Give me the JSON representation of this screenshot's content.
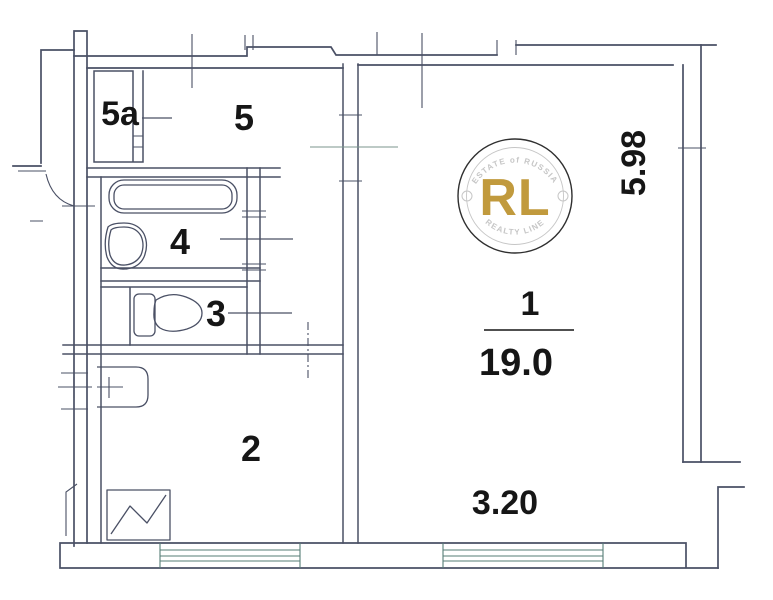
{
  "plan": {
    "room_labels": [
      {
        "id": "5a",
        "label": "5a"
      },
      {
        "id": "5",
        "label": "5"
      },
      {
        "id": "4",
        "label": "4"
      },
      {
        "id": "3",
        "label": "3"
      },
      {
        "id": "2",
        "label": "2"
      },
      {
        "id": "1",
        "label": "1"
      }
    ],
    "area_value": "19.0",
    "dim_width": "3.20",
    "dim_height": "5.98"
  },
  "watermark": {
    "monogram": "RL",
    "top_text": "ESTATE of RUSSIA",
    "bottom_text": "REALTY LINE"
  },
  "colors": {
    "background": "#ffffff",
    "wall_line": "#4a5065",
    "window_line": "#567d76",
    "label_text": "#161616",
    "gold": "#c19a3d",
    "stamp_gray": "#c6c6c6",
    "stamp_ring": "#2f2f2f"
  }
}
